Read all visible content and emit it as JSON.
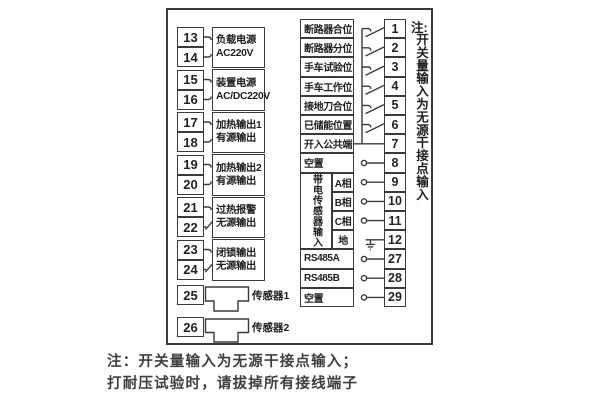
{
  "left": {
    "pairs": [
      {
        "top_terminal": "13",
        "bottom_terminal": "14",
        "label_line1": "负载电源",
        "label_line2": "AC220V"
      },
      {
        "top_terminal": "15",
        "bottom_terminal": "16",
        "label_line1": "装置电源",
        "label_line2": "AC/DC220V"
      },
      {
        "top_terminal": "17",
        "bottom_terminal": "18",
        "label_line1": "加热输出1",
        "label_line2": "有源输出"
      },
      {
        "top_terminal": "19",
        "bottom_terminal": "20",
        "label_line1": "加热输出2",
        "label_line2": "有源输出"
      },
      {
        "top_terminal": "21",
        "bottom_terminal": "22",
        "label_line1": "过热报警",
        "label_line2": "无源输出"
      },
      {
        "top_terminal": "23",
        "bottom_terminal": "24",
        "label_line1": "闭锁输出",
        "label_line2": "无源输出"
      }
    ],
    "sensors": [
      {
        "terminal": "25",
        "label": "传感器1"
      },
      {
        "terminal": "26",
        "label": "传感器2"
      }
    ]
  },
  "right": {
    "sensor_group_label": "带电传感器输入",
    "rows": [
      {
        "label": "断路器合位",
        "terminal": "1",
        "link": "switch"
      },
      {
        "label": "断路器分位",
        "terminal": "2",
        "link": "switch"
      },
      {
        "label": "手车试验位",
        "terminal": "3",
        "link": "switch"
      },
      {
        "label": "手车工作位",
        "terminal": "4",
        "link": "switch"
      },
      {
        "label": "接地刀合位",
        "terminal": "5",
        "link": "switch"
      },
      {
        "label": "已储能位置",
        "terminal": "6",
        "link": "switch"
      },
      {
        "label": "开入公共端",
        "terminal": "7",
        "link": "line"
      },
      {
        "label": "空置",
        "terminal": "8",
        "link": "plug"
      },
      {
        "label": "A相",
        "terminal": "9",
        "link": "plug"
      },
      {
        "label": "B相",
        "terminal": "10",
        "link": "plug"
      },
      {
        "label": "C相",
        "terminal": "11",
        "link": "plug"
      },
      {
        "label": "地",
        "terminal": "12",
        "link": "ground"
      },
      {
        "label": "RS485A",
        "terminal": "27",
        "link": "plug"
      },
      {
        "label": "RS485B",
        "terminal": "28",
        "link": "plug"
      },
      {
        "label": "空置",
        "terminal": "29",
        "link": "plug"
      }
    ]
  },
  "side_note": {
    "prefix": "注:",
    "text": "开关量输入为无源干接点输入"
  },
  "footer": {
    "line1": "注：开关量输入为无源干接点输入；",
    "line2": "打耐压试验时，请拔掉所有接线端子"
  },
  "colors": {
    "line": "#3a3a3a",
    "text": "#1f1f1f",
    "background": "#ffffff"
  }
}
